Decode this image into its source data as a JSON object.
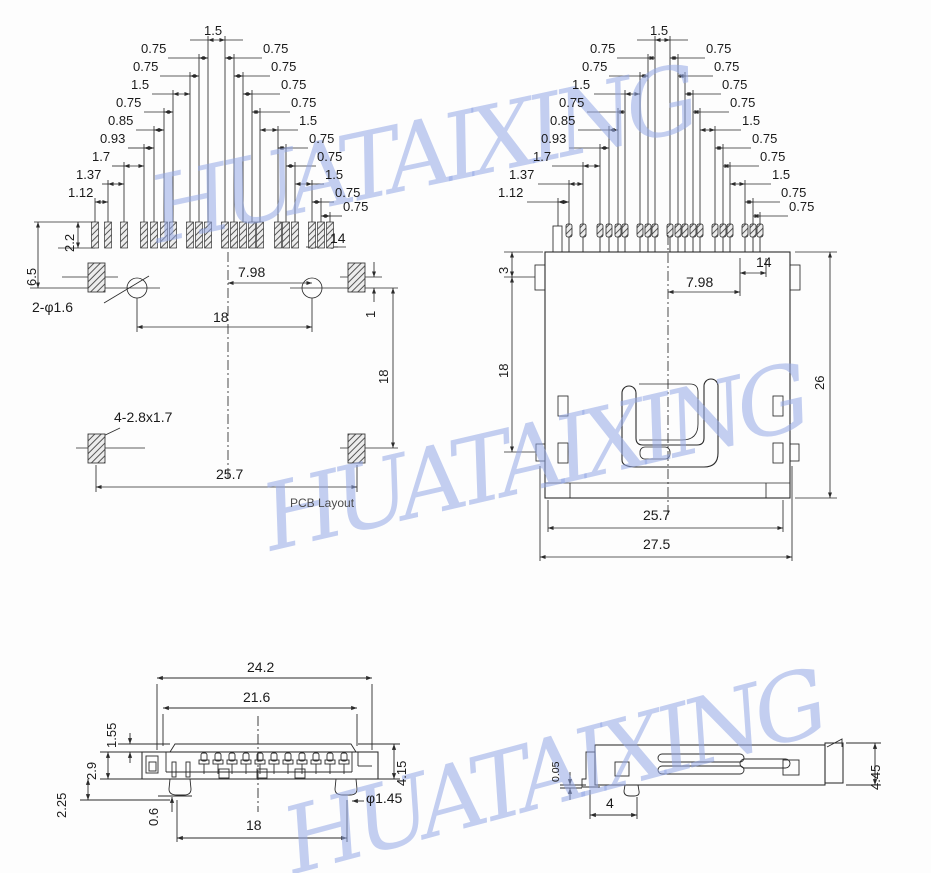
{
  "watermark": {
    "text": "HUATAIXING",
    "color": "#94a7e6"
  },
  "ladder": {
    "top": "1.5",
    "left": [
      "0.75",
      "0.75",
      "1.5",
      "0.75",
      "0.85",
      "0.93",
      "1.7",
      "1.37",
      "1.12"
    ],
    "right": [
      "0.75",
      "0.75",
      "0.75",
      "0.75",
      "1.5",
      "0.75",
      "0.75",
      "1.5",
      "0.75",
      "0.75"
    ]
  },
  "pcb": {
    "pad_height": "2.2",
    "edge_to_hole": "6.5",
    "holes": "2-φ1.6",
    "pitch_right": "7.98",
    "hole_span": "18",
    "pad_width": "14",
    "pad_offset": "1",
    "vertical_span": "18",
    "slot_note": "4-2.8x1.7",
    "mount_span": "25.7",
    "caption": "PCB Layout"
  },
  "front": {
    "pin_row": "3",
    "side_height": "18",
    "total_height": "26",
    "pitch_right": "7.98",
    "pad_width": "14",
    "inner_width": "25.7",
    "outer_width": "27.5"
  },
  "side": {
    "outer_width": "24.2",
    "inner_width": "21.6",
    "lid_height": "1.55",
    "shell_height": "2.9",
    "lower_height": "2.25",
    "foot": "0.6",
    "pin_span": "18",
    "peg_dia": "φ1.45",
    "total_height": "4.15"
  },
  "profile": {
    "lip": "0.05",
    "foot_offset": "4",
    "total_height": "4.45"
  }
}
